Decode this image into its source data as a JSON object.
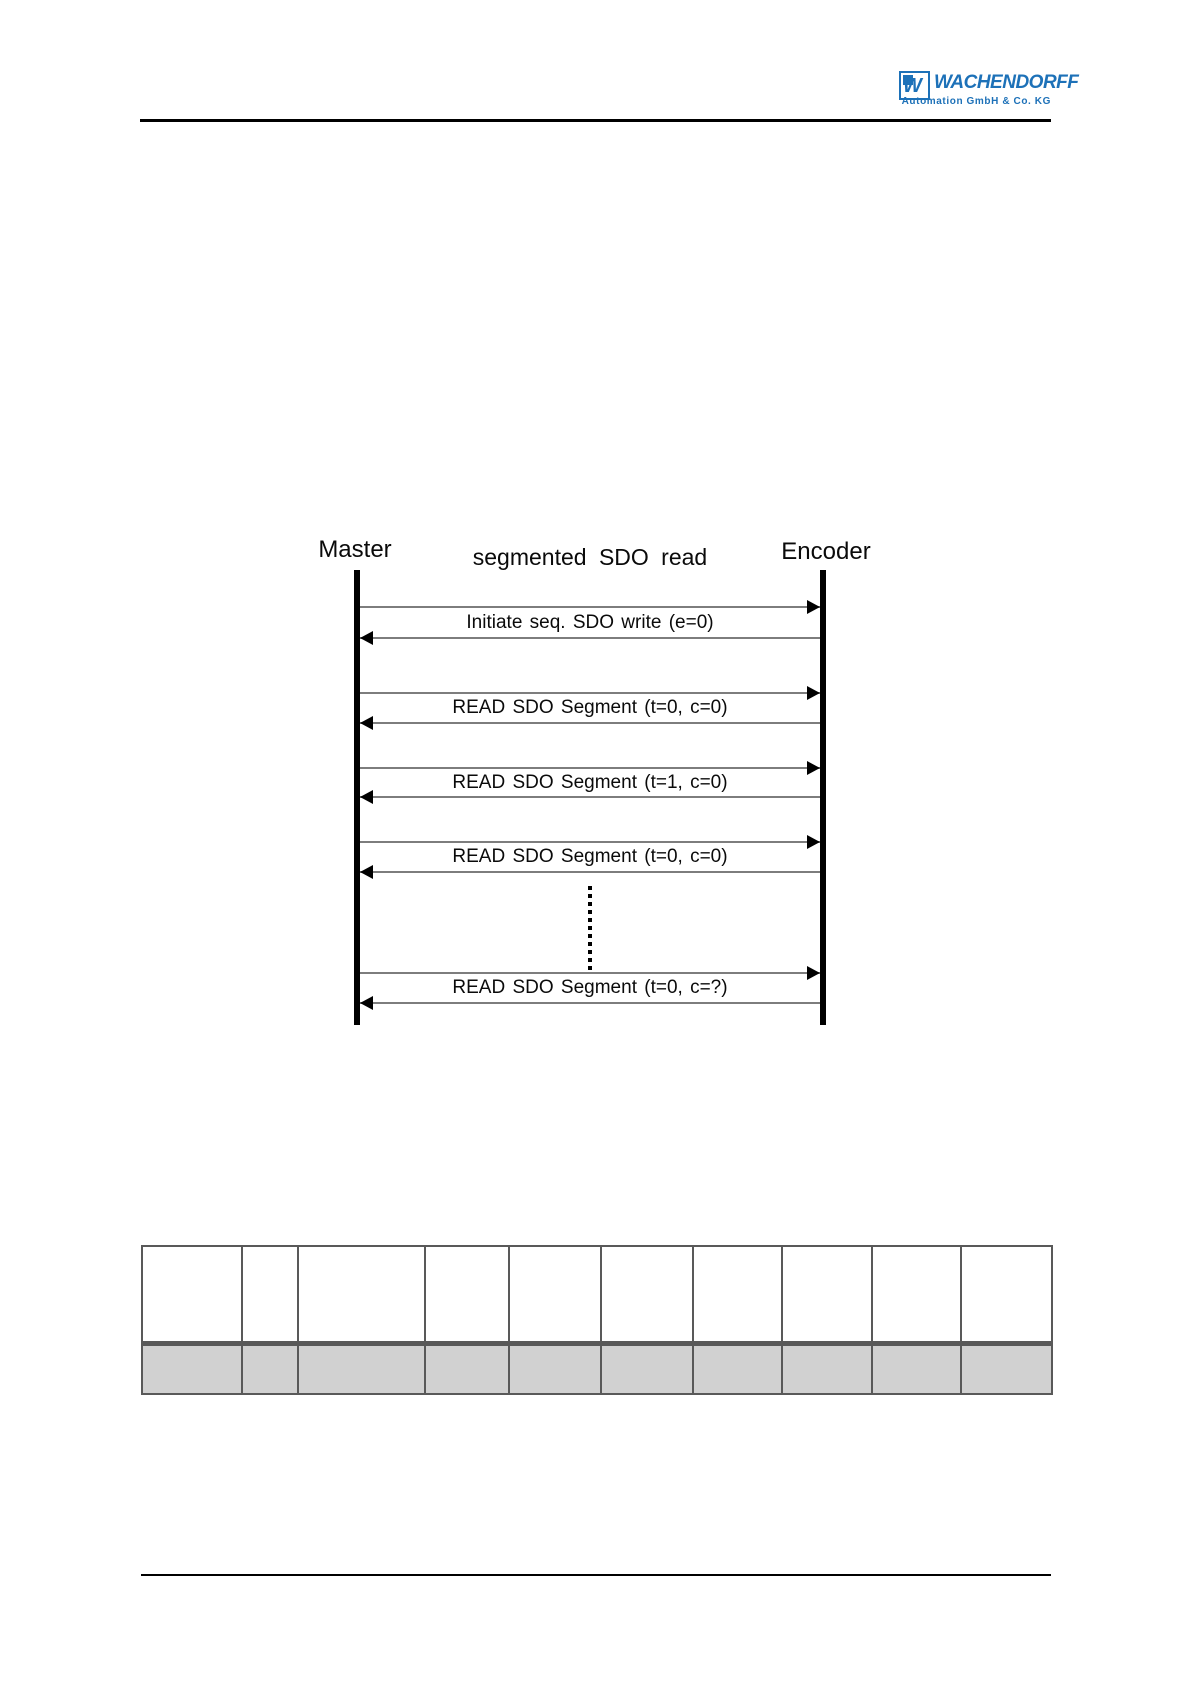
{
  "colors": {
    "accent": "#1d71b8",
    "table_border": "#595959",
    "table_row_gray": "#d1d1d1",
    "arrow_line_gray": "#7d7d7d"
  },
  "header": {
    "logo": {
      "monogram": "W",
      "brand": "WACHENDORFF",
      "subtitle": "Automation GmbH & Co. KG",
      "color": "#1d71b8"
    }
  },
  "diagram": {
    "title": "segmented SDO read",
    "left_actor": "Master",
    "right_actor": "Encoder",
    "messages": [
      {
        "label": "Initiate seq. SDO write (e=0)"
      },
      {
        "label": "READ SDO Segment (t=0, c=0)"
      },
      {
        "label": "READ SDO Segment (t=1, c=0)"
      },
      {
        "label": "READ SDO Segment (t=0, c=0)"
      },
      {
        "label": "READ SDO Segment (t=0, c=?)"
      }
    ],
    "continuation_dots_between": [
      4,
      5
    ]
  },
  "table": {
    "column_count": 10,
    "header_row": [
      "",
      "",
      "",
      "",
      "",
      "",
      "",
      "",
      "",
      ""
    ],
    "body_rows": [
      [
        "",
        "",
        "",
        "",
        "",
        "",
        "",
        "",
        "",
        ""
      ]
    ]
  }
}
